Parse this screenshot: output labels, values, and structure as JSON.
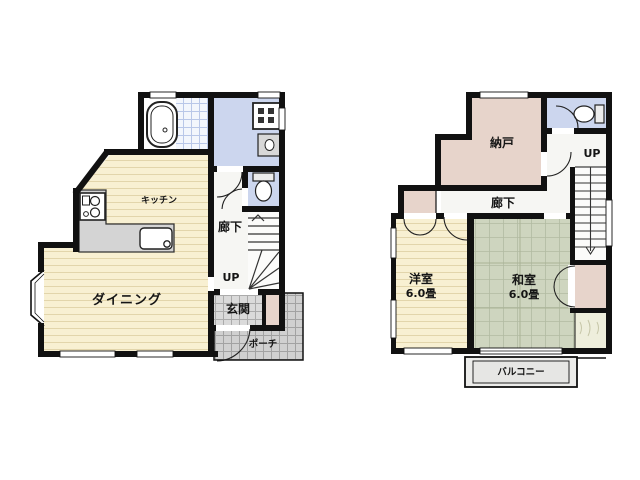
{
  "background_color": "#ffffff",
  "wall_color": "#111111",
  "palette": {
    "wood_floor": "#f8f0d2",
    "wood_line": "#e2d5ab",
    "tatami_floor": "#ced5bf",
    "washroom_floor": "#ccd6ee",
    "closet_fill": "#e7d4cb",
    "entrance_tile": "#dadada",
    "porch_tile": "#d0d0d0",
    "counter": "#d4d4d4",
    "balcony": "#ececea"
  },
  "floor1": {
    "labels": {
      "kitchen": "キッチン",
      "dining": "ダイニング",
      "hallway": "廊下",
      "stairs_direction": "UP",
      "entrance": "玄関",
      "porch": "ポーチ"
    },
    "fixtures": [
      "bathtub-icon",
      "bath-tile",
      "washing-machine-icon",
      "washbasin-icon",
      "toilet-icon",
      "stove-icon",
      "kitchen-counter",
      "kitchen-sink-icon",
      "staircase-up",
      "bay-window"
    ]
  },
  "floor2": {
    "labels": {
      "storeroom": "納戸",
      "hallway": "廊下",
      "stairs_direction": "UP",
      "western_room": "洋室",
      "western_room_size": "6.0畳",
      "japanese_room": "和室",
      "japanese_room_size": "6.0畳",
      "balcony": "バルコニー"
    },
    "fixtures": [
      "toilet-icon",
      "staircase-down",
      "closet",
      "oshiire-closet",
      "storage-shelf",
      "balcony-rail"
    ]
  }
}
